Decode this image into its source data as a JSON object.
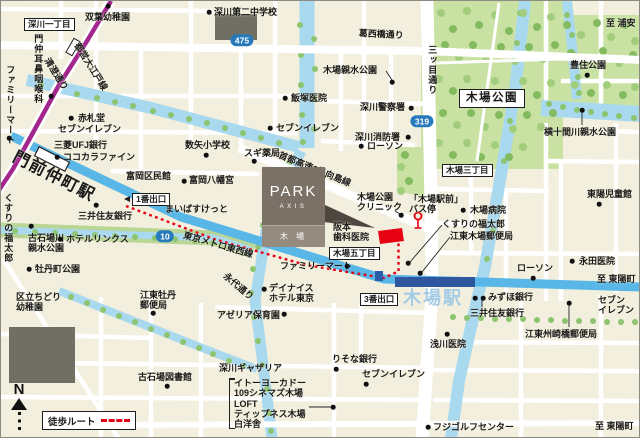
{
  "compass": {
    "label": "N"
  },
  "legend": {
    "walk_route": "徒歩ルート"
  },
  "property": {
    "name": "PARK",
    "brand": "AXIS",
    "place": "木 場"
  },
  "colors": {
    "walk_route_red": "#e60012",
    "tozai_line_blue": "#58b7e7",
    "station_bar_blue": "#2f579f",
    "oedo_line_purple": "#a2268e",
    "route_badge_blue": "#2679bb",
    "park_green": "#c9e2a3",
    "river_blue": "#a9d9ef",
    "property_card_taupe": "#7b7166",
    "kiba_station_text": "#a6cbe5"
  },
  "badges": [
    {
      "number": "475",
      "x": 241,
      "y": 39
    },
    {
      "number": "319",
      "x": 421,
      "y": 120
    },
    {
      "number": "10",
      "x": 164,
      "y": 235
    }
  ],
  "labels": [
    {
      "id": "fukagawa-1chome",
      "kind": "boxed",
      "text": "深川一丁目",
      "x": 23,
      "y": 17
    },
    {
      "id": "futaba-kindergarten",
      "text": "双葉幼稚園",
      "x": 84,
      "y": 11,
      "dots": [
        [
          107,
          5
        ]
      ]
    },
    {
      "id": "fukagawa-dai2-junior-high",
      "text": "深川第二中学校",
      "x": 213,
      "y": 6,
      "dots": [
        [
          208,
          11
        ]
      ]
    },
    {
      "id": "kasaibashi-dori",
      "kind": "road",
      "text": "葛西橋通り",
      "x": 358,
      "y": 27,
      "rotate": 3
    },
    {
      "id": "to-urayasu",
      "kind": "direction",
      "text": "至 浦安",
      "x": 605,
      "y": 17
    },
    {
      "id": "mitsume-dori",
      "kind": "road",
      "text": "三ッ目通り",
      "x": 426,
      "y": 44,
      "vertical": true
    },
    {
      "id": "kiba-shinsui-koen",
      "text": "木場親水公園",
      "x": 322,
      "y": 64,
      "dots": [
        [
          391,
          81
        ]
      ]
    },
    {
      "id": "toyosumi-koen",
      "text": "豊住公園",
      "x": 569,
      "y": 59,
      "dots": [
        [
          586,
          74
        ]
      ]
    },
    {
      "id": "iizuka-clinic",
      "text": "飯塚医院",
      "x": 290,
      "y": 92,
      "dots": [
        [
          284,
          97
        ]
      ]
    },
    {
      "id": "fukagawa-police",
      "text": "深川警察署",
      "x": 359,
      "y": 101,
      "dots": [
        [
          410,
          107
        ]
      ]
    },
    {
      "id": "yokojukkengawa-shinsui-koen",
      "text": "横十間川親水公園",
      "x": 543,
      "y": 126,
      "dots": [
        [
          581,
          109
        ]
      ]
    },
    {
      "id": "akafudado",
      "text": "赤札堂",
      "x": 77,
      "y": 112,
      "dots": [
        [
          70,
          117
        ]
      ]
    },
    {
      "id": "seven-eleven-monzen",
      "text": "セブンイレブン",
      "x": 57,
      "y": 123
    },
    {
      "id": "seven-eleven-north",
      "text": "セブンイレブン",
      "x": 275,
      "y": 122,
      "dots": [
        [
          269,
          127
        ]
      ]
    },
    {
      "id": "fukagawa-fire",
      "text": "深川消防署",
      "x": 354,
      "y": 131,
      "dots": [
        [
          407,
          136
        ]
      ]
    },
    {
      "id": "lawson-north",
      "text": "ローソン",
      "x": 366,
      "y": 140,
      "dots": [
        [
          360,
          145
        ]
      ]
    },
    {
      "id": "kazuya-elementary",
      "text": "数矢小学校",
      "x": 184,
      "y": 139,
      "dots": [
        [
          205,
          154
        ]
      ]
    },
    {
      "id": "mitsubishi-ufj-bank",
      "text": "三菱UFJ銀行",
      "x": 53,
      "y": 139
    },
    {
      "id": "cocokara-fine",
      "text": "ココカラファイン",
      "x": 62,
      "y": 151,
      "dots": [
        [
          56,
          156
        ]
      ]
    },
    {
      "id": "sugi-drug",
      "text": "スギ薬局",
      "x": 243,
      "y": 147,
      "dots": [
        [
          253,
          160
        ]
      ]
    },
    {
      "id": "monnaka-ent-clinic",
      "text": "門仲耳鼻咽喉科",
      "x": 32,
      "y": 33,
      "vertical": true,
      "dots": [
        [
          50,
          95
        ]
      ]
    },
    {
      "id": "family-mart-monzen",
      "text": "ファミリーマート",
      "x": 4,
      "y": 64,
      "vertical": true,
      "dots": [
        [
          8,
          137
        ]
      ]
    },
    {
      "id": "toei-oedo-line",
      "kind": "road",
      "text": "都営大江戸線",
      "x": 80,
      "y": 40,
      "rotate": 58
    },
    {
      "id": "kiyosumi-dori",
      "kind": "road",
      "text": "清澄通り",
      "x": 50,
      "y": 55,
      "rotate": 58
    },
    {
      "id": "shuto-expwy-6-mukojima",
      "kind": "road",
      "text": "首都高速6号向島線",
      "x": 280,
      "y": 149,
      "rotate": 22
    },
    {
      "id": "kiba-koen-label",
      "kind": "boxed-big",
      "text": "木場公園",
      "x": 458,
      "y": 88
    },
    {
      "id": "kiba-3chome",
      "kind": "boxed",
      "text": "木場三丁目",
      "x": 441,
      "y": 163
    },
    {
      "id": "monzen-nakacho-station",
      "kind": "station-big",
      "text": "門前仲町駅",
      "x": 17,
      "y": 147,
      "rotate": 27
    },
    {
      "id": "tomioka-kuminkan",
      "text": "富岡区民館",
      "x": 125,
      "y": 170
    },
    {
      "id": "tomioka-hachimangu",
      "text": "富岡八幡宮",
      "x": 188,
      "y": 174,
      "dots": [
        [
          183,
          180
        ]
      ]
    },
    {
      "id": "exit-1",
      "kind": "boxed",
      "text": "1番出口",
      "x": 131,
      "y": 192,
      "arrow": "left"
    },
    {
      "id": "maibasuketto",
      "text": "まいばすけっと",
      "x": 164,
      "y": 203
    },
    {
      "id": "smbc-monzen",
      "text": "三井住友銀行",
      "x": 77,
      "y": 210,
      "dots": [
        [
          95,
          204
        ]
      ]
    },
    {
      "id": "kusuri-fukutaro-west",
      "text": "くすりの福太郎",
      "x": 2,
      "y": 192,
      "vertical": true
    },
    {
      "id": "koishibagawa-shinsui-koen",
      "lines": [
        "古石場川",
        "親水公園"
      ],
      "x": 27,
      "y": 232,
      "dots": [
        [
          30,
          225
        ]
      ]
    },
    {
      "id": "hotel-links",
      "text": "ホテルリンクス",
      "x": 65,
      "y": 233,
      "dots": [
        [
          59,
          238
        ]
      ]
    },
    {
      "id": "botancho-koen",
      "text": "牡丹町公園",
      "x": 34,
      "y": 263,
      "dots": [
        [
          28,
          268
        ]
      ]
    },
    {
      "id": "tokyo-metro-tozai-line",
      "kind": "road",
      "text": "東京メトロ東西線",
      "x": 184,
      "y": 229,
      "rotate": 16
    },
    {
      "id": "eitai-dori",
      "kind": "road",
      "text": "永代通り",
      "x": 227,
      "y": 270,
      "rotate": 40
    },
    {
      "id": "kiba-koen-clinic",
      "lines": [
        "木場公園",
        "クリニック"
      ],
      "x": 356,
      "y": 191,
      "dots": [
        [
          400,
          214
        ]
      ]
    },
    {
      "id": "kiba-ekimae-bus-stop",
      "lines": [
        "「木場駅前」",
        "バス停"
      ],
      "x": 408,
      "y": 193
    },
    {
      "id": "kiba-hospital",
      "text": "木場病院",
      "x": 469,
      "y": 204,
      "dots": [
        [
          462,
          209
        ]
      ]
    },
    {
      "id": "kusuri-fukutaro-east",
      "text": "くすりの福太郎",
      "x": 441,
      "y": 218,
      "dots": [
        [
          407,
          262
        ]
      ]
    },
    {
      "id": "koto-kiba-post-office",
      "text": "江東木場郵便局",
      "x": 449,
      "y": 230,
      "dots": [
        [
          419,
          272
        ]
      ]
    },
    {
      "id": "toyo-jidokan",
      "text": "東陽児童館",
      "x": 586,
      "y": 188,
      "dots": [
        [
          598,
          203
        ]
      ]
    },
    {
      "id": "sakamoto-dental",
      "lines": [
        "阪本",
        "歯科医院"
      ],
      "x": 332,
      "y": 221
    },
    {
      "id": "kiba-5chome",
      "kind": "boxed",
      "text": "木場五丁目",
      "x": 328,
      "y": 246
    },
    {
      "id": "family-mart-kiba",
      "text": "ファミリーマート",
      "x": 279,
      "y": 260,
      "dots": [
        [
          346,
          265
        ]
      ]
    },
    {
      "id": "nagata-clinic",
      "text": "永田医院",
      "x": 578,
      "y": 255,
      "dots": [
        [
          571,
          260
        ]
      ]
    },
    {
      "id": "lawson-east",
      "text": "ローソン",
      "x": 516,
      "y": 262,
      "dots": [
        [
          532,
          277
        ]
      ]
    },
    {
      "id": "to-toyocho-east",
      "kind": "direction",
      "text": "至 東陽町",
      "x": 596,
      "y": 273
    },
    {
      "id": "dainice-hotel-tokyo",
      "lines": [
        "デイナイス",
        "ホテル東京"
      ],
      "x": 268,
      "y": 282,
      "dots": [
        [
          263,
          288
        ]
      ]
    },
    {
      "id": "kiba-station-big",
      "kind": "kiba-big",
      "text": "木場駅",
      "x": 402,
      "y": 287
    },
    {
      "id": "exit-3",
      "kind": "boxed",
      "text": "3番出口",
      "x": 359,
      "y": 292
    },
    {
      "id": "mizuho-bank",
      "text": "みずほ銀行",
      "x": 487,
      "y": 291,
      "dots": [
        [
          474,
          297
        ],
        [
          482,
          297
        ]
      ]
    },
    {
      "id": "smbc-kiba",
      "text": "三井住友銀行",
      "x": 469,
      "y": 307
    },
    {
      "id": "seven-eleven-east",
      "lines": [
        "セブン",
        "イレブン"
      ],
      "x": 597,
      "y": 294
    },
    {
      "id": "azalea-hoikuen",
      "text": "アゼリア保育園",
      "x": 216,
      "y": 309,
      "dots": [
        [
          283,
          313
        ]
      ]
    },
    {
      "id": "asakawa-clinic",
      "text": "浅川医院",
      "x": 429,
      "y": 338,
      "dots": [
        [
          446,
          333
        ]
      ]
    },
    {
      "id": "koto-suzakibashi-post-office",
      "text": "江東州崎橋郵便局",
      "x": 524,
      "y": 328,
      "dots": [
        [
          568,
          302
        ]
      ]
    },
    {
      "id": "risona-bank",
      "text": "りそな銀行",
      "x": 331,
      "y": 353,
      "dots": [
        [
          335,
          368
        ]
      ]
    },
    {
      "id": "fukagawa-gatharia",
      "text": "深川ギャザリア",
      "x": 218,
      "y": 362
    },
    {
      "id": "seven-eleven-south",
      "text": "セブンイレブン",
      "x": 361,
      "y": 368,
      "dots": [
        [
          365,
          383
        ]
      ]
    },
    {
      "id": "gatharia-facilities",
      "kind": "bracket",
      "lines": [
        "イトーヨーカドー",
        "109シネマズ木場",
        "LOFT",
        "ティップネス木場",
        "白洋舎"
      ],
      "x": 228,
      "y": 377,
      "dots": [
        [
          332,
          406
        ]
      ]
    },
    {
      "id": "koishiba-library",
      "text": "古石場図書館",
      "x": 137,
      "y": 371,
      "dots": [
        [
          166,
          385
        ]
      ]
    },
    {
      "id": "chidori-kindergarten",
      "lines": [
        "区立ちどり",
        "幼稚園"
      ],
      "x": 15,
      "y": 291
    },
    {
      "id": "koto-botan-post-office",
      "lines": [
        "江東牡丹",
        "郵便局"
      ],
      "x": 139,
      "y": 289,
      "dots": [
        [
          152,
          312
        ]
      ]
    },
    {
      "id": "fuji-golf-center",
      "text": "フジゴルフセンター",
      "x": 432,
      "y": 421,
      "dots": [
        [
          427,
          426
        ]
      ]
    },
    {
      "id": "to-toyocho-south",
      "kind": "direction",
      "text": "至 東陽町",
      "x": 594,
      "y": 420
    }
  ]
}
